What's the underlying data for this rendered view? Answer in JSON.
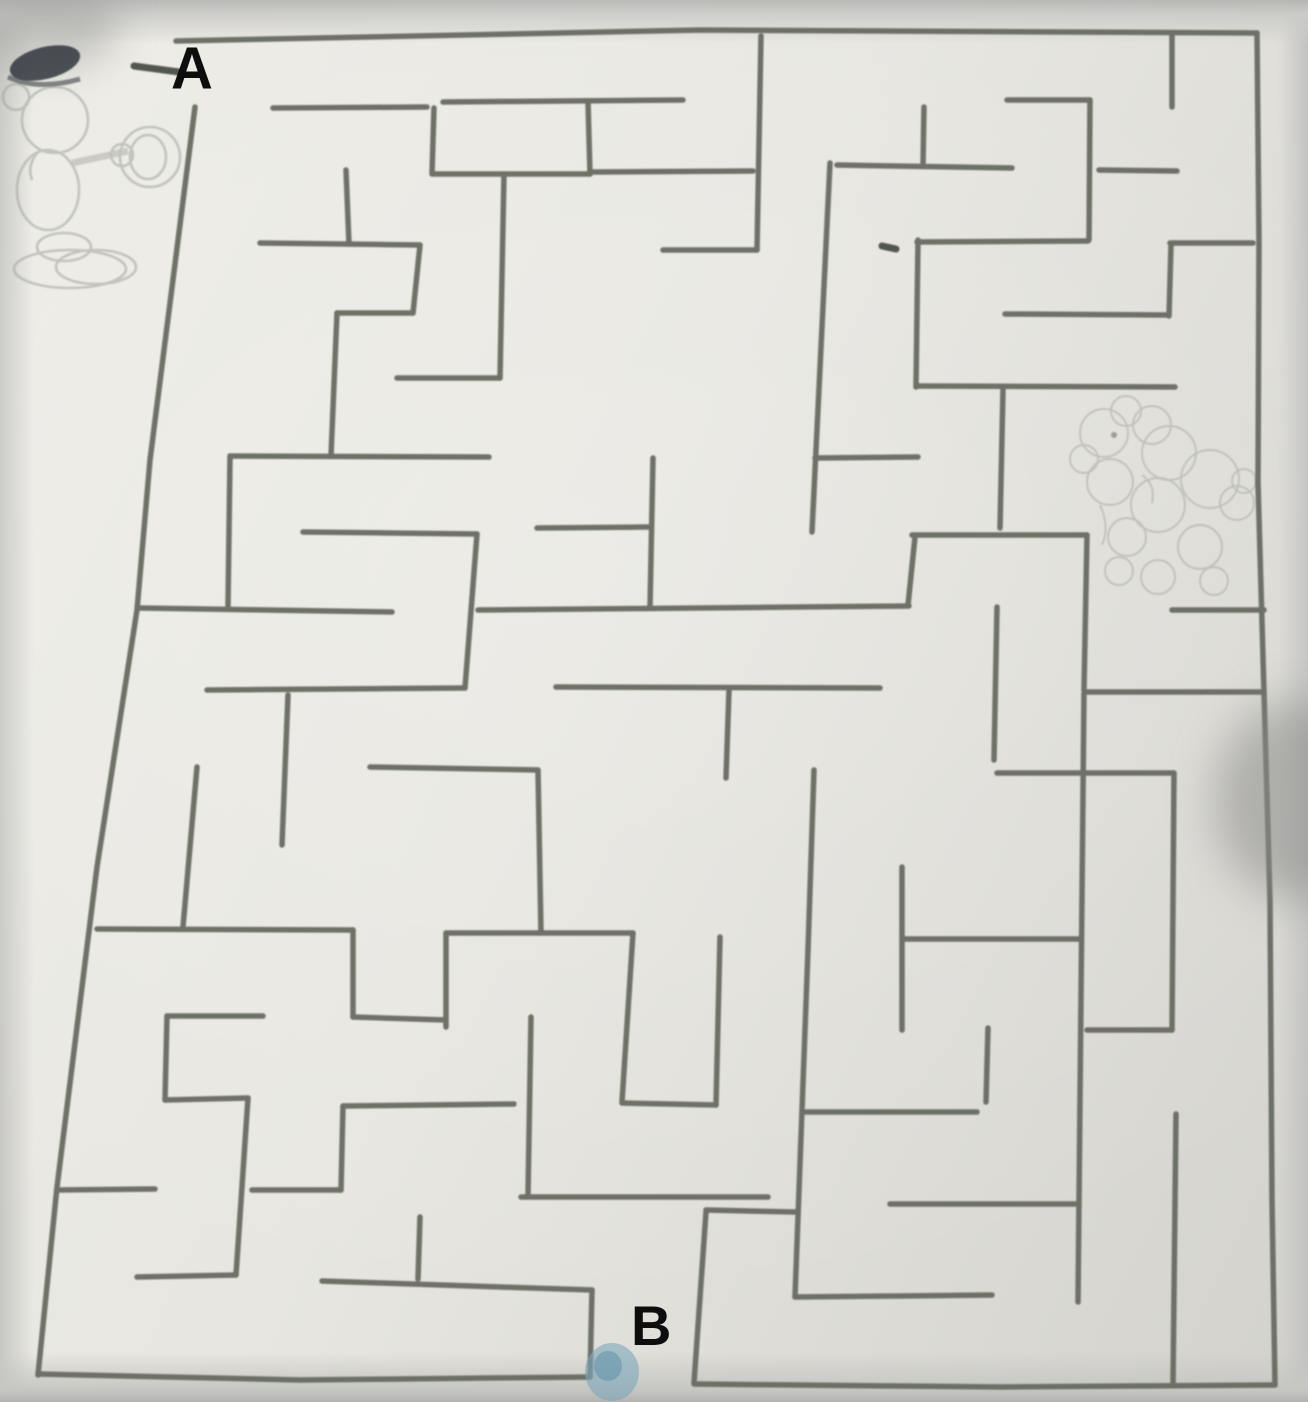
{
  "scene": {
    "description": "photograph of a hand-drawn maze worksheet",
    "start_label": "A",
    "end_label": "B"
  },
  "labels": {
    "start": "A",
    "end": "B"
  },
  "colors": {
    "paper": "#e4e3dd",
    "paper_edge": "#c6c6c3",
    "wall": "#666a5e",
    "label_text": "#0d0d0d",
    "pencil_sketch": "#9fa29b",
    "dog_sketch": "#a6a99e",
    "mickey_cap": "#2c3136",
    "blue_smudge": "#7ba6ba"
  },
  "maze": {
    "stroke_width": 5.5,
    "entrance": {
      "label": "A",
      "side": "top-left"
    },
    "exit": {
      "label": "B",
      "side": "bottom-center"
    },
    "border": [
      [
        [
          195,
          107
        ],
        [
          150,
          460
        ],
        [
          137,
          610
        ],
        [
          97,
          867
        ],
        [
          57,
          1187
        ],
        [
          38,
          1375
        ]
      ],
      [
        [
          176,
          41
        ],
        [
          700,
          30
        ],
        [
          1257,
          33
        ]
      ],
      [
        [
          1257,
          33
        ],
        [
          1259,
          243
        ],
        [
          1258,
          483
        ],
        [
          1264,
          692
        ],
        [
          1270,
          900
        ],
        [
          1272,
          1200
        ],
        [
          1275,
          1385
        ]
      ],
      [
        [
          1275,
          1385
        ],
        [
          1000,
          1387
        ],
        [
          694,
          1384
        ]
      ],
      [
        [
          590,
          1377
        ],
        [
          300,
          1380
        ],
        [
          38,
          1374
        ]
      ]
    ],
    "walls": [
      [
        273,
        108,
        427,
        107
      ],
      [
        434,
        108,
        432,
        174
      ],
      [
        443,
        102,
        683,
        100
      ],
      [
        433,
        174,
        590,
        174
      ],
      [
        588,
        102,
        590,
        174
      ],
      [
        590,
        172,
        753,
        171
      ],
      [
        761,
        36,
        757,
        250
      ],
      [
        663,
        250,
        757,
        250
      ],
      [
        346,
        170,
        349,
        244
      ],
      [
        260,
        243,
        420,
        245
      ],
      [
        420,
        245,
        413,
        313
      ],
      [
        337,
        313,
        413,
        313
      ],
      [
        337,
        313,
        331,
        456
      ],
      [
        230,
        456,
        489,
        457
      ],
      [
        230,
        457,
        228,
        606
      ],
      [
        504,
        174,
        500,
        378
      ],
      [
        397,
        378,
        500,
        378
      ],
      [
        830,
        163,
        812,
        532
      ],
      [
        815,
        458,
        918,
        457
      ],
      [
        917,
        386,
        1175,
        387
      ],
      [
        918,
        240,
        916,
        387
      ],
      [
        917,
        242,
        1088,
        241
      ],
      [
        924,
        107,
        923,
        166
      ],
      [
        837,
        165,
        1012,
        168
      ],
      [
        1007,
        100,
        1090,
        100
      ],
      [
        1090,
        100,
        1089,
        240
      ],
      [
        1099,
        170,
        1177,
        171
      ],
      [
        1172,
        33,
        1172,
        107
      ],
      [
        1170,
        243,
        1253,
        243
      ],
      [
        1171,
        245,
        1169,
        316
      ],
      [
        1005,
        314,
        1168,
        315
      ],
      [
        1003,
        390,
        1000,
        528
      ],
      [
        912,
        535,
        1087,
        535
      ],
      [
        915,
        537,
        908,
        605
      ],
      [
        1087,
        535,
        1084,
        690
      ],
      [
        1087,
        692,
        1264,
        692
      ],
      [
        1172,
        610,
        1264,
        610
      ],
      [
        997,
        607,
        994,
        760
      ],
      [
        997,
        773,
        1174,
        773
      ],
      [
        1174,
        773,
        1172,
        1030
      ],
      [
        303,
        532,
        477,
        534
      ],
      [
        477,
        534,
        465,
        688
      ],
      [
        207,
        690,
        465,
        688
      ],
      [
        288,
        695,
        282,
        845
      ],
      [
        537,
        528,
        648,
        527
      ],
      [
        140,
        608,
        392,
        612
      ],
      [
        478,
        610,
        909,
        606
      ],
      [
        653,
        458,
        650,
        608
      ],
      [
        556,
        687,
        880,
        688
      ],
      [
        729,
        690,
        726,
        778
      ],
      [
        814,
        770,
        808,
        950
      ],
      [
        808,
        950,
        795,
        1297
      ],
      [
        370,
        767,
        538,
        770
      ],
      [
        538,
        770,
        541,
        933
      ],
      [
        446,
        933,
        633,
        933
      ],
      [
        446,
        933,
        446,
        1027
      ],
      [
        353,
        1017,
        446,
        1020
      ],
      [
        353,
        930,
        353,
        1017
      ],
      [
        97,
        929,
        353,
        930
      ],
      [
        197,
        767,
        183,
        927
      ],
      [
        57,
        1190,
        155,
        1189
      ],
      [
        167,
        1016,
        263,
        1016
      ],
      [
        167,
        1016,
        165,
        1100
      ],
      [
        165,
        1100,
        248,
        1098
      ],
      [
        248,
        1098,
        236,
        1275
      ],
      [
        137,
        1277,
        236,
        1275
      ],
      [
        633,
        933,
        622,
        1102
      ],
      [
        622,
        1103,
        716,
        1105
      ],
      [
        716,
        1105,
        720,
        937
      ],
      [
        531,
        1017,
        528,
        1195
      ],
      [
        521,
        1197,
        768,
        1197
      ],
      [
        343,
        1106,
        514,
        1104
      ],
      [
        343,
        1106,
        341,
        1190
      ],
      [
        252,
        1190,
        341,
        1190
      ],
      [
        420,
        1217,
        418,
        1279
      ],
      [
        322,
        1281,
        592,
        1290
      ],
      [
        592,
        1290,
        590,
        1377
      ],
      [
        706,
        1212,
        694,
        1383
      ],
      [
        706,
        1210,
        795,
        1212
      ],
      [
        795,
        1297,
        992,
        1295
      ],
      [
        806,
        1112,
        977,
        1112
      ],
      [
        902,
        867,
        902,
        1030
      ],
      [
        904,
        939,
        1079,
        939
      ],
      [
        1084,
        693,
        1078,
        1302
      ],
      [
        1087,
        1030,
        1172,
        1030
      ],
      [
        890,
        1204,
        1079,
        1204
      ],
      [
        1176,
        1114,
        1173,
        1385
      ],
      [
        988,
        1028,
        986,
        1102
      ]
    ],
    "marks": [
      [
        134,
        66,
        179,
        72
      ],
      [
        882,
        246,
        896,
        249
      ]
    ]
  },
  "sketches": {
    "mickey": {
      "present": true,
      "x": 0,
      "y": 25,
      "note": "faint pencil cartoon character with dark cap, top-left outside maze"
    },
    "dog": {
      "present": true,
      "x": 1072,
      "y": 385,
      "note": "faint fluffy dog sketch inside right side of maze"
    }
  },
  "smudge": {
    "x": 612,
    "y": 1372,
    "rx": 27,
    "ry": 29
  }
}
